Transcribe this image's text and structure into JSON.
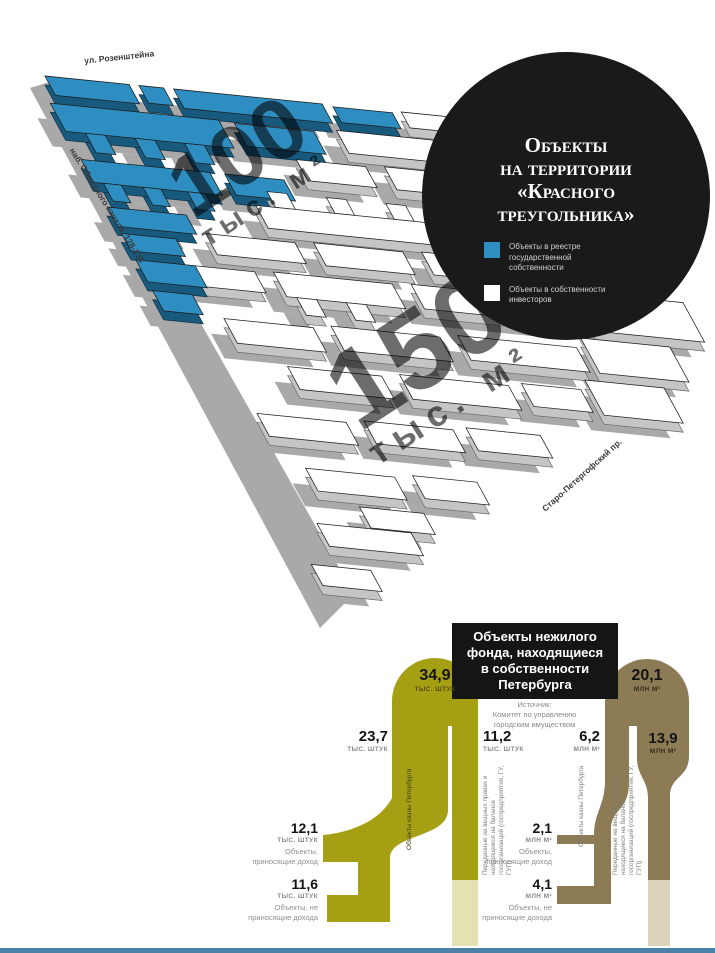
{
  "map": {
    "street_rozenshteyna": "ул. Розенштейна",
    "street_obvodny": "наб. Обводного канала, 128-138",
    "street_petergofsky": "Старо-Петергофский пр.",
    "area_state": {
      "value": "100",
      "unit": "тыс. м²"
    },
    "area_investors": {
      "value": "150",
      "unit": "тыс. м²"
    },
    "colors": {
      "state_objects": "#2e8ec1",
      "investor_objects": "#ffffff",
      "shadow": "#a9a9a9"
    },
    "callout": {
      "title_lines": [
        "Объекты",
        "на территории",
        "«Красного",
        "треугольника»"
      ],
      "legend": [
        {
          "swatch": "#2e8ec1",
          "label": "Объекты в реестре государственной собственности"
        },
        {
          "swatch": "#ffffff",
          "label": "Объекты в собственности инвесторов"
        }
      ]
    }
  },
  "chart": {
    "title_lines": [
      "Объекты нежилого",
      "фонда, находящиеся",
      "в собственности",
      "Петербурга"
    ],
    "source_lines": [
      "Источник:",
      "Комитет по управлению",
      "городским имуществом"
    ],
    "left": {
      "color": "#a5a013",
      "total": {
        "value": "34,9",
        "unit": "тыс. штук"
      },
      "kazna": {
        "value": "23,7",
        "unit": "тыс. штук",
        "label": "Объекты казны Петербурга"
      },
      "transferred": {
        "value": "11,2",
        "unit": "тыс. штук",
        "label": "Переданные на вещных правах и находящиеся на балансе госорганизаций (госпредприятия, ГУ, ГУП)"
      },
      "profitable": {
        "value": "12,1",
        "unit": "тыс. штук",
        "label": "Объекты, приносящие доход"
      },
      "unprofitable": {
        "value": "11,6",
        "unit": "тыс. штук",
        "label": "Объекты, не приносящие дохода"
      }
    },
    "right": {
      "color": "#8c7b55",
      "total": {
        "value": "20,1",
        "unit": "млн м²"
      },
      "kazna": {
        "value": "6,2",
        "unit": "млн м²",
        "label": "Объекты казны Петербурга"
      },
      "transferred": {
        "value": "13,9",
        "unit": "млн м²",
        "label": "Переданные на вещных правах и находящиеся на балансе госорганизаций (госпредприятия, ГУ, ГУП)"
      },
      "profitable": {
        "value": "2,1",
        "unit": "млн м²",
        "label": "Объекты, приносящие доход"
      },
      "unprofitable": {
        "value": "4,1",
        "unit": "млн м²",
        "label": "Объекты, не приносящие дохода"
      }
    }
  },
  "chart_data": [
    {
      "type": "bar",
      "title": "Объекты нежилого фонда, находящиеся в собственности Петербурга",
      "source": "Источник: Комитет по управлению городским имуществом",
      "unit": "тыс. штук",
      "categories": [
        "Всего",
        "Объекты казны Петербурга",
        "Переданные на вещных правах и находящиеся на балансе госорганизаций (госпредприятия, ГУ, ГУП)",
        "Объекты казны, приносящие доход",
        "Объекты казны, не приносящие дохода"
      ],
      "values": [
        34.9,
        23.7,
        11.2,
        12.1,
        11.6
      ]
    },
    {
      "type": "bar",
      "title": "Объекты нежилого фонда, находящиеся в собственности Петербурга",
      "unit": "млн м²",
      "categories": [
        "Всего",
        "Объекты казны Петербурга",
        "Переданные на вещных правах и находящиеся на балансе госорганизаций (госпредприятия, ГУ, ГУП)",
        "Объекты казны, приносящие доход",
        "Объекты казны, не приносящие дохода"
      ],
      "values": [
        20.1,
        6.2,
        13.9,
        2.1,
        4.1
      ]
    },
    {
      "type": "bar",
      "title": "Объекты на территории «Красного треугольника»",
      "unit": "тыс. м²",
      "categories": [
        "Объекты в реестре государственной собственности",
        "Объекты в собственности инвесторов"
      ],
      "values": [
        100,
        150
      ]
    }
  ]
}
